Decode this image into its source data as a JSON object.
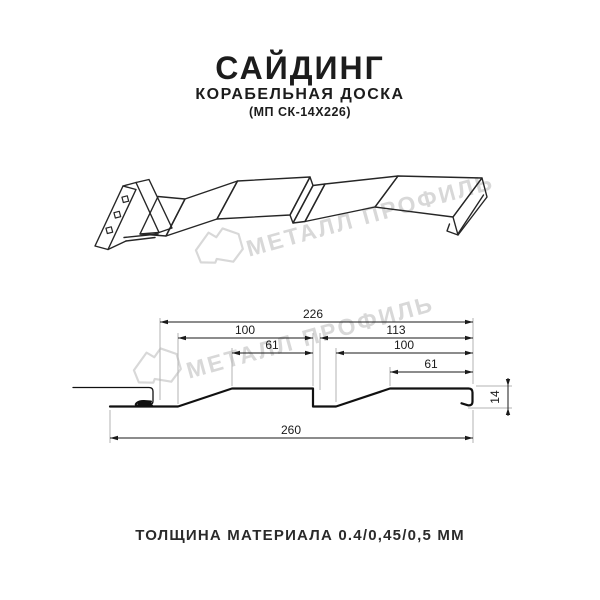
{
  "header": {
    "title": "САЙДИНГ",
    "subtitle": "КОРАБЕЛЬНАЯ ДОСКА",
    "model": "(МП СК-14Х226)"
  },
  "watermark": {
    "brand": "МЕТАЛЛ ПРОФИЛЬ",
    "color": "#d8d8d8",
    "logo": "metal-profile-logo"
  },
  "cross_section": {
    "dimensions": {
      "overall_top": "226",
      "board_left": "100",
      "board_right": "113",
      "flat_left": "61",
      "inner_right": "100",
      "flat_right": "61",
      "overall_bottom": "260",
      "profile_height": "14"
    }
  },
  "footer": {
    "thickness_label": "ТОЛЩИНА МАТЕРИАЛА 0.4/0,45/0,5 ММ"
  },
  "colors": {
    "line": "#1a1a1a",
    "profile": "#111111",
    "extension": "#b3b3b3",
    "background": "#ffffff"
  }
}
